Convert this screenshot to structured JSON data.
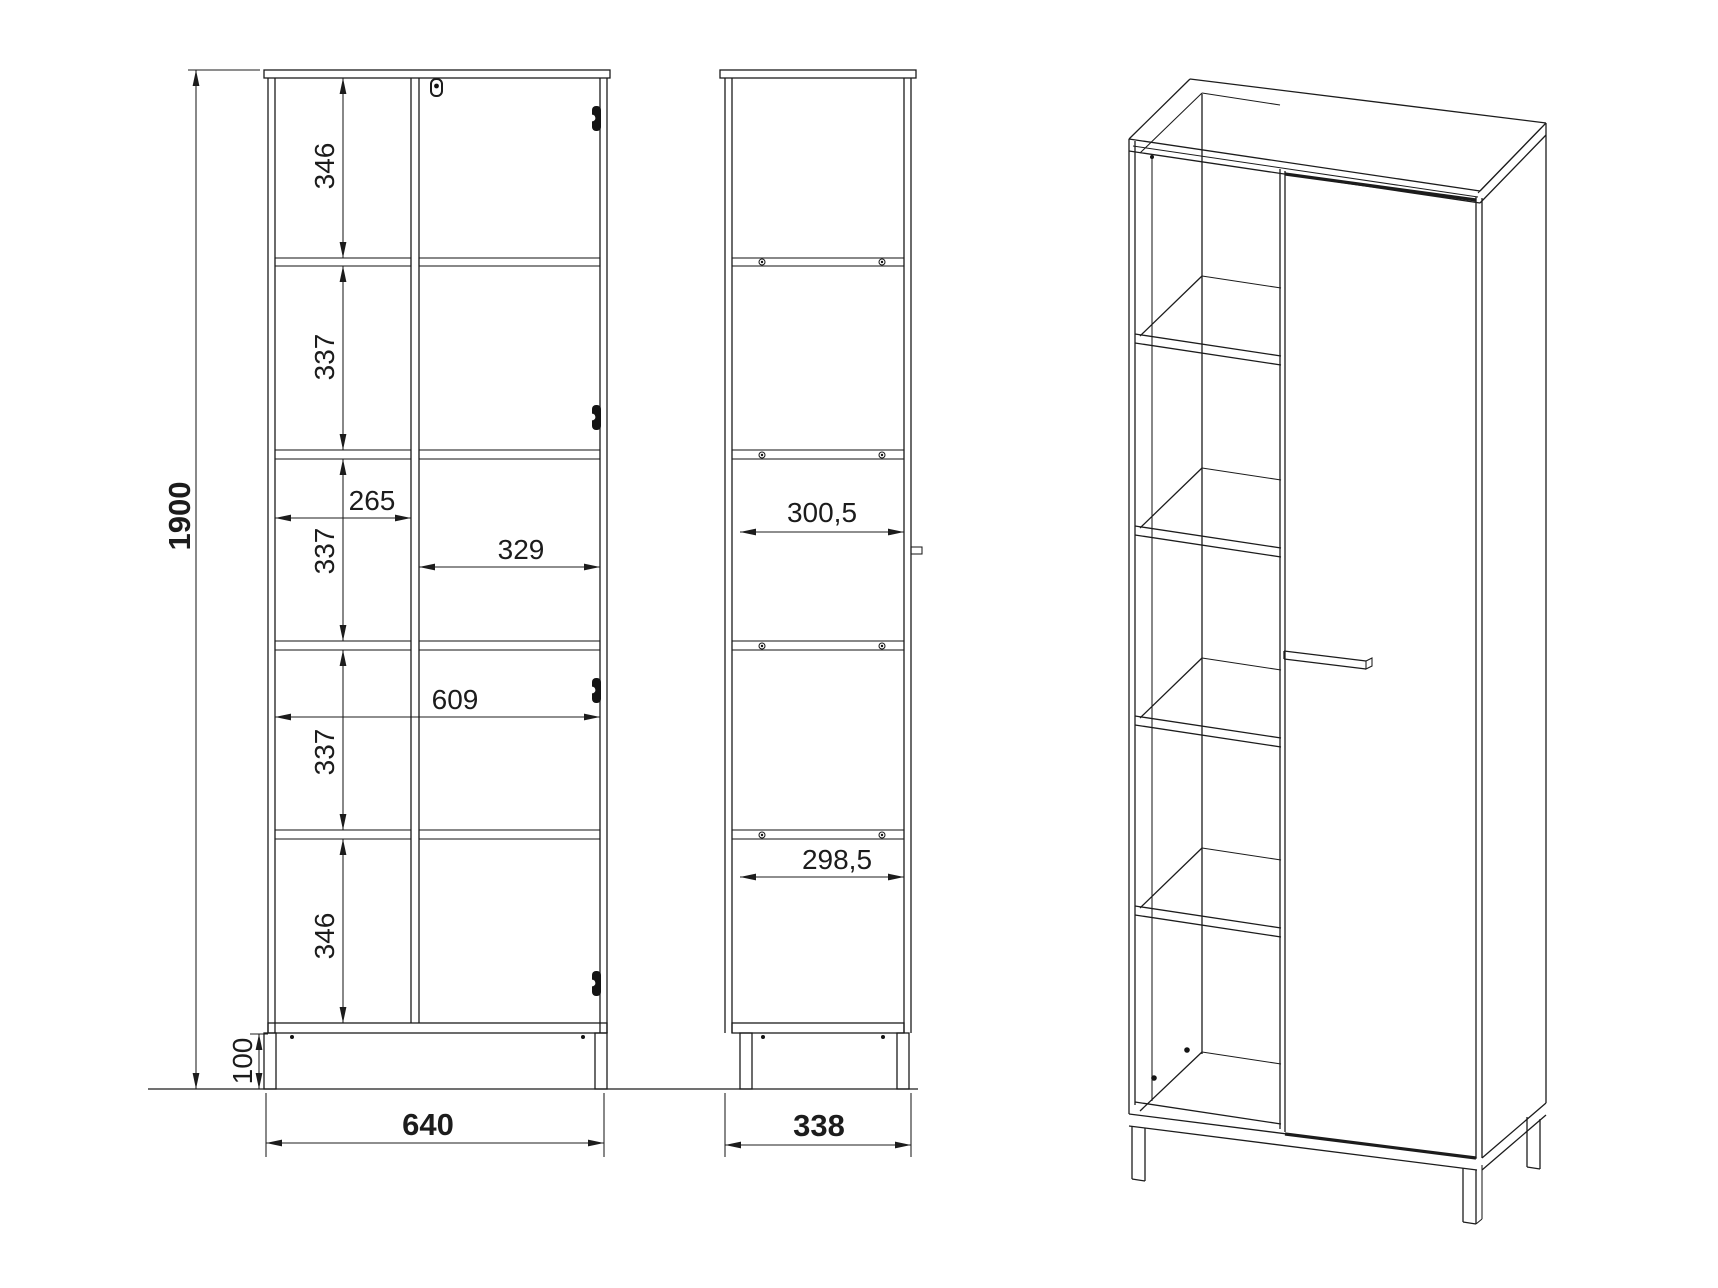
{
  "drawing_type": "furniture-technical-drawing",
  "colors": {
    "line": "#1c1c1c",
    "background": "#ffffff"
  },
  "front_view": {
    "total_height": "1900",
    "shelf_spacings": [
      "346",
      "337",
      "337",
      "337",
      "346"
    ],
    "left_column_width": "265",
    "right_column_width": "329",
    "inner_width": "609",
    "base_height": "100",
    "total_width": "640"
  },
  "side_view": {
    "upper_inner_depth": "300,5",
    "lower_inner_depth": "298,5",
    "total_depth": "338"
  }
}
